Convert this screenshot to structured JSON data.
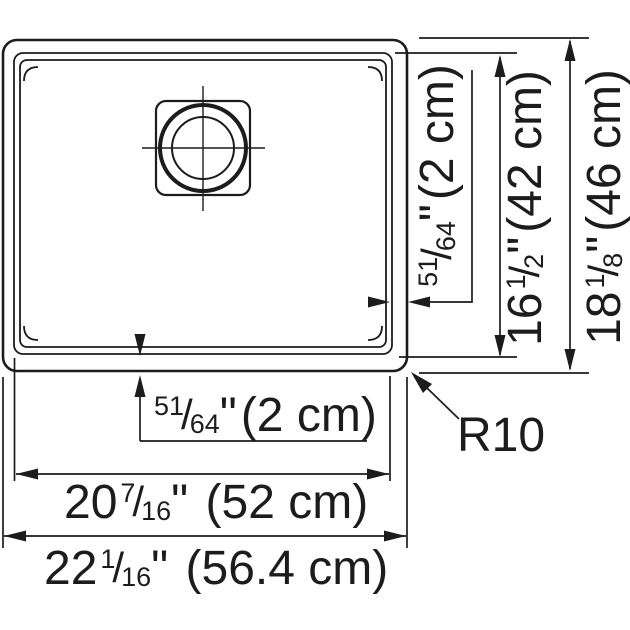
{
  "drawing": {
    "type": "sink-plan-spec",
    "colors": {
      "line": "#1c1c1c",
      "background": "#ffffff"
    },
    "labels": {
      "frac_slash": "/",
      "rim_offset_right": {
        "num": "51",
        "den": "64",
        "inch": "\"",
        "metric": "(2 cm)"
      },
      "bowl_depth": {
        "whole": "16",
        "num": "1",
        "den": "2",
        "inch": "\"",
        "metric": "(42 cm)"
      },
      "overall_depth": {
        "whole": "18",
        "num": "1",
        "den": "8",
        "inch": "\"",
        "metric": "(46 cm)"
      },
      "rim_offset_bottom": {
        "num": "51",
        "den": "64",
        "inch": "\"",
        "metric": "(2 cm)"
      },
      "bowl_width": {
        "whole": "20",
        "num": "7",
        "den": "16",
        "inch": "\"",
        "metric": " (52 cm)"
      },
      "overall_width": {
        "whole": "22",
        "num": "1",
        "den": "16",
        "inch": "\"",
        "metric": " (56.4 cm)"
      },
      "corner_radius": "R10"
    }
  }
}
